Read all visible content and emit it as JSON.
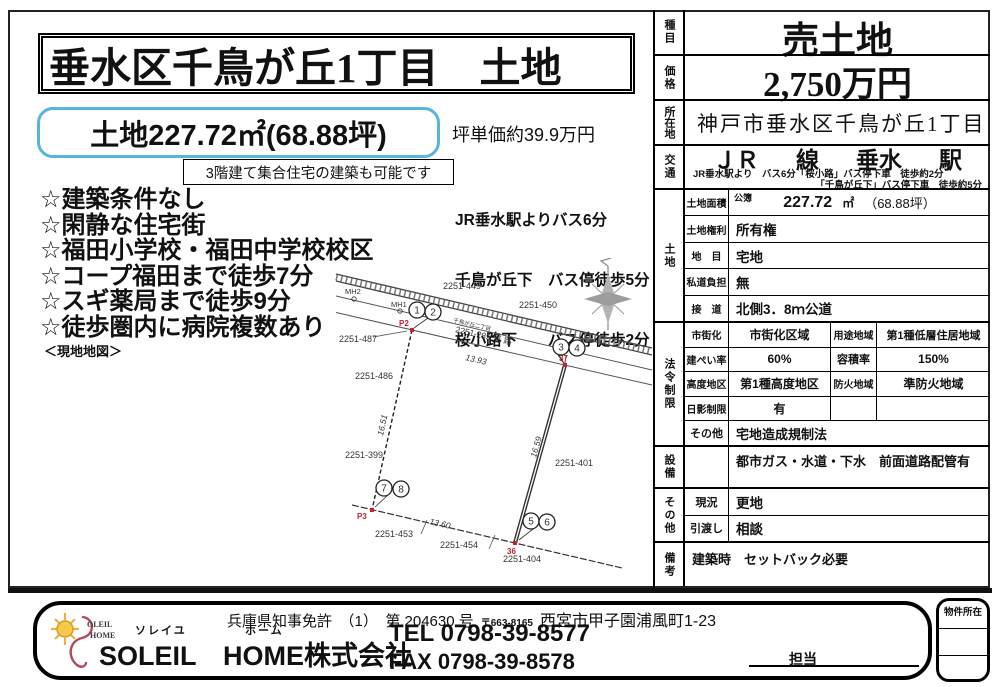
{
  "page": {
    "title": "垂水区千鳥が丘1丁目　土地",
    "area_badge": "土地227.72㎡(68.88坪)",
    "tsubo_price": "坪単価約39.9万円",
    "build_note": "3階建て集合住宅の建築も可能です",
    "access_lines": [
      "JR垂水駅よりバス6分",
      "千鳥が丘下　バス停徒歩5分",
      "桜小路下　　バス停徒歩2分"
    ],
    "features": [
      "☆建築条件なし",
      "☆閑静な住宅街",
      "☆福田小学校・福田中学校校区",
      "☆コープ福田まで徒歩7分",
      "☆スギ薬局まで徒歩9分",
      "☆徒歩圏内に病院複数あり"
    ],
    "map_caption": "＜現地地図＞"
  },
  "spec": {
    "category_label": "種目",
    "category": "売土地",
    "price_label": "価格",
    "price": "2,750万円",
    "location_label": "所在地",
    "location": "神戸市垂水区千鳥が丘1丁目",
    "transport_label": "交通",
    "rail": "ＪＲ",
    "sen": "線",
    "station": "垂水",
    "eki": "駅",
    "transport_detail1": "JR垂水駅より　バス6分「桜小路」バス停下車　徒歩約2分",
    "transport_detail2": "「千鳥が丘下」バス停下車　徒歩約5分",
    "land_label": "土地",
    "area_label": "土地面積",
    "area_register": "公簿",
    "area_value": "227.72",
    "area_unit": "㎡",
    "area_tsubo": "（68.88坪）",
    "right_label": "土地権利",
    "right_value": "所有権",
    "chimoku_label": "地　目",
    "chimoku_value": "宅地",
    "private_label": "私道負担",
    "private_value": "無",
    "setsudo_label": "接　道",
    "setsudo_value": "北側3．8ｍ公道",
    "law_label": "法令制限",
    "law_rows": [
      {
        "l1": "市街化",
        "v1": "市街化区域",
        "l2": "用途地域",
        "v2": "第1種低層住居地域"
      },
      {
        "l1": "建ぺい率",
        "v1": "60%",
        "l2": "容積率",
        "v2": "150%"
      },
      {
        "l1": "高度地区",
        "v1": "第1種高度地区",
        "l2": "防火地域",
        "v2": "準防火地域"
      },
      {
        "l1": "日影制限",
        "v1": "有",
        "l2": "",
        "v2": ""
      }
    ],
    "law_other_label": "その他",
    "law_other_value": "宅地造成規制法",
    "setsubi_label": "設備",
    "setsubi_value": "都市ガス・水道・下水　前面道路配管有",
    "sonota_label": "その他",
    "genkyo_label": "現況",
    "genkyo_value": "更地",
    "hikiwatashi_label": "引渡し",
    "hikiwatashi_value": "相談",
    "biko_label": "備考",
    "biko_value": "建築時　セットバック必要"
  },
  "map": {
    "labels": [
      "MH2",
      "MH1",
      "2251-449",
      "2251-450",
      "2251-487",
      "2251-486",
      "千鳥が丘二丁目",
      "2251-289 道 路",
      "2251-399",
      "2251-401",
      "2251-453",
      "2251-454",
      "2251-404"
    ],
    "measurements": [
      "13.93",
      "16.59",
      "13.60",
      "16.51"
    ],
    "red_marks": [
      "P2",
      "37",
      "P3",
      "36"
    ],
    "points": [
      "1",
      "2",
      "3",
      "4",
      "5",
      "6",
      "7",
      "8"
    ]
  },
  "footer": {
    "license": "兵庫県知事免許　（1）　第 204630 号",
    "postal": "〒663-8165",
    "address": "西宮市甲子園浦風町1-23",
    "furigana_soleil": "ソレイユ",
    "furigana_home": "ホーム",
    "company": "SOLEIL　HOME株式会社",
    "logo_line1": "OLEIL",
    "logo_line2": "HOME",
    "tel": "TEL 0798-39-8577",
    "fax": "FAX 0798-39-8578",
    "tanto": "担当",
    "bukken": "物件所在"
  }
}
